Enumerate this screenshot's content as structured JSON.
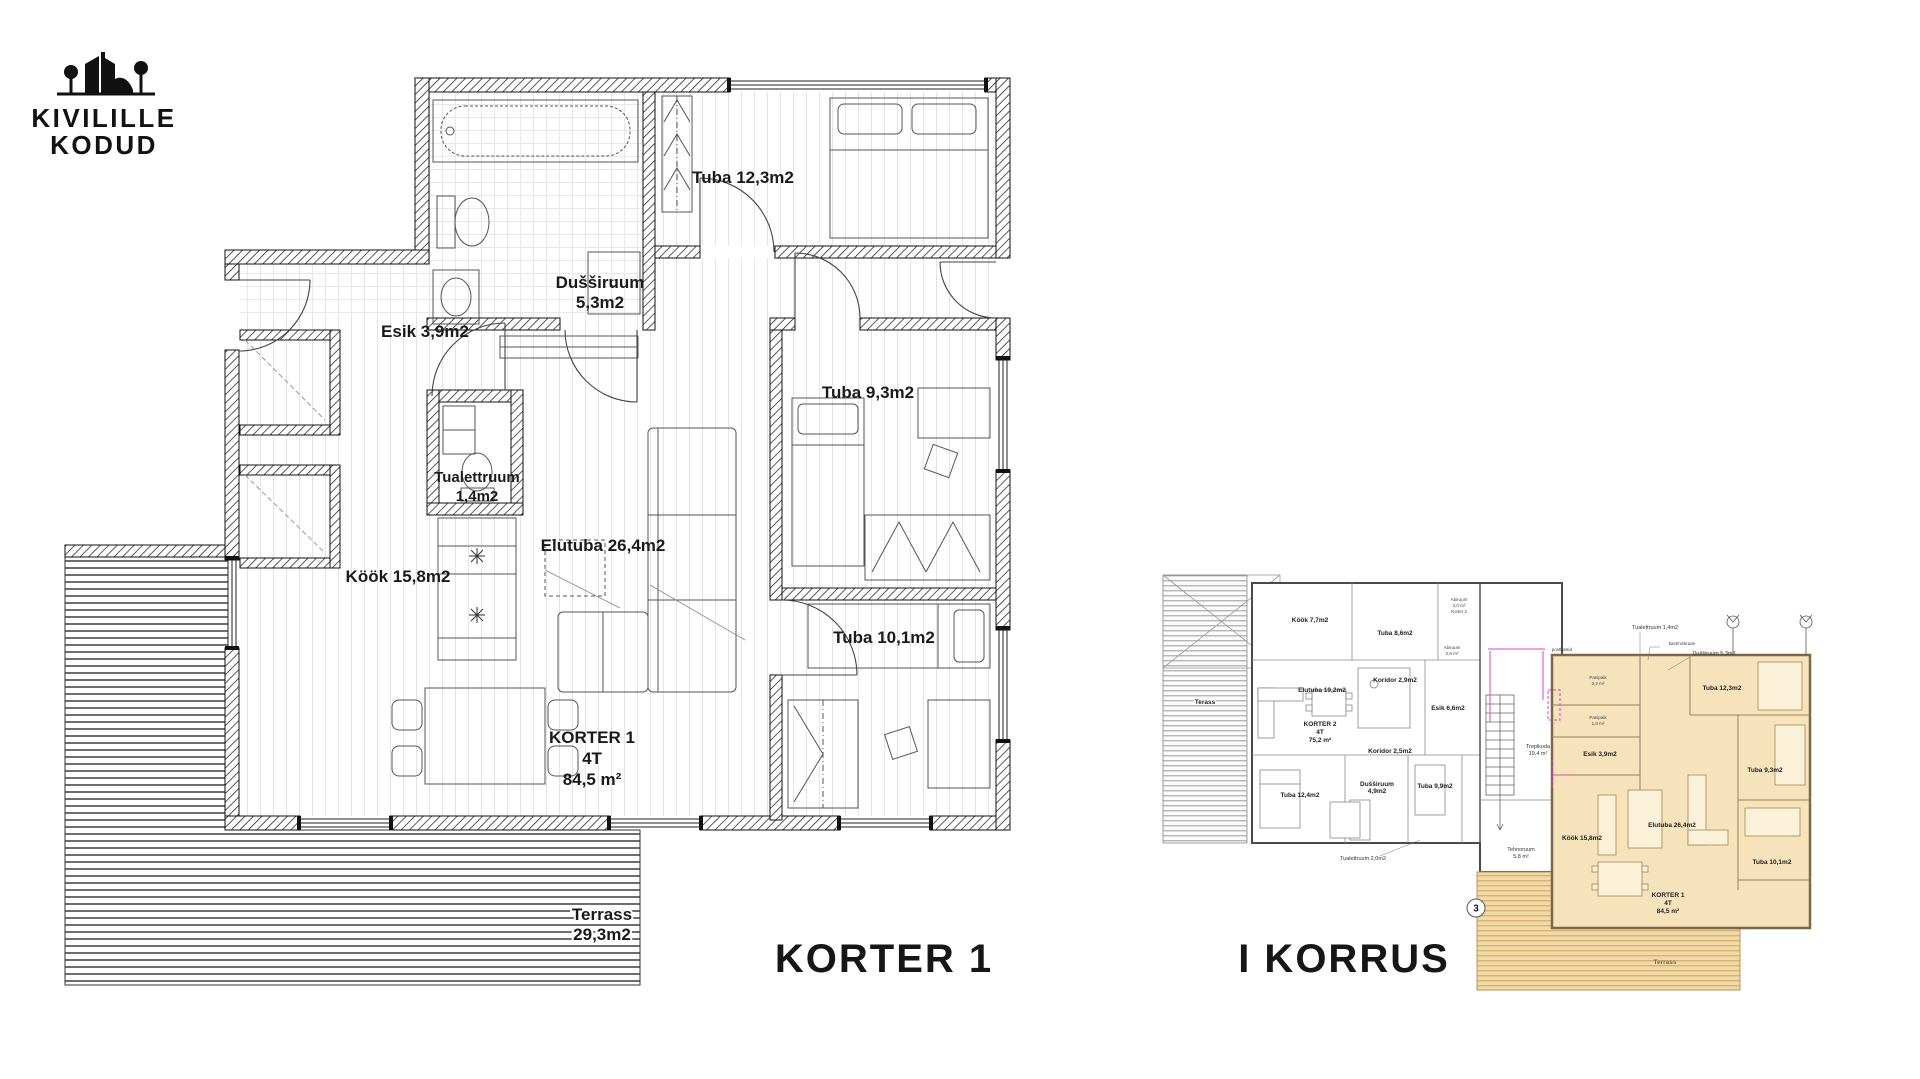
{
  "logo": {
    "line1": "KIVILILLE",
    "line2": "KODUD"
  },
  "captions": {
    "main": "KORTER 1",
    "floor": "I KORRUS"
  },
  "colors": {
    "ink": "#1a1a1a",
    "tan_fill": "#f6e3bb",
    "tan_wall": "#7a684a",
    "magenta": "#e23ed2"
  },
  "main_plan": {
    "dussiruum_name": "Dušširuum",
    "dussiruum_area": "5,3m2",
    "tuba_12": "Tuba 12,3m2",
    "esik": "Esik 3,9m2",
    "tualettruum_name": "Tualettruum",
    "tualettruum_area": "1,4m2",
    "kook": "Köök 15,8m2",
    "elutuba": "Elutuba 26,4m2",
    "tuba_9": "Tuba 9,3m2",
    "tuba_10": "Tuba 10,1m2",
    "apartment_name": "KORTER 1",
    "apartment_type": "4T",
    "apartment_area": "84,5 m²",
    "terrass_name": "Terrass",
    "terrass_area": "29,3m2"
  },
  "overview_plan": {
    "terass_left": "Terass",
    "kook_k2": "Köök 7,7m2",
    "tuba_8_k2": "Tuba 8,6m2",
    "abiruum1_name": "Abiruum",
    "abiruum1_area": "3,0 m²",
    "abiruum1_note": "Korter 2",
    "abiruum2_name": "Abiruum",
    "abiruum2_area": "2,8 m²",
    "koridor1_k2": "Koridor 2,9m2",
    "elutuba_k2": "Elutuba 19,2m2",
    "korter2_name": "KORTER 2",
    "korter2_type": "4T",
    "korter2_area": "75,2 m²",
    "esik_k2": "Esik 6,6m2",
    "koridor2_k2": "Koridor 2,5m2",
    "tuba_12_k2": "Tuba 12,4m2",
    "dussiruum_k2_name": "Dušširuum",
    "dussiruum_k2_area": "4,9m2",
    "tuba_9_k2": "Tuba 9,9m2",
    "tualettruum_k2": "Tualettruum 2,0m2",
    "trepikoda_name": "Trepikoda",
    "trepikoda_area": "19,4 m²",
    "tehnoruum_name": "Tehnoruum",
    "tehnoruum_area": "5,8 m²",
    "marker": "3",
    "postkastid": "postkastid",
    "leader_tualettruum": "Tualettruum 1,4m2",
    "leader_kastmiskraan": "kastmiskraan",
    "leader_dussiruum": "Dušširuum 5,3m2",
    "panipaik1_name": "Panipaik",
    "panipaik1_area": "3,2 m²",
    "panipaik2_name": "Panipaik",
    "panipaik2_area": "1,8 m²",
    "esik_k1": "Esik 3,9m2",
    "tuba_12_k1": "Tuba 12,3m2",
    "tuba_9_k1": "Tuba 9,3m2",
    "kook_k1": "Köök 15,8m2",
    "elutuba_k1": "Elutuba 26,4m2",
    "tuba_10_k1": "Tuba 10,1m2",
    "korter1_name": "KORTER 1",
    "korter1_type": "4T",
    "korter1_area": "84,5 m²",
    "terrass_k1": "Terrass"
  }
}
